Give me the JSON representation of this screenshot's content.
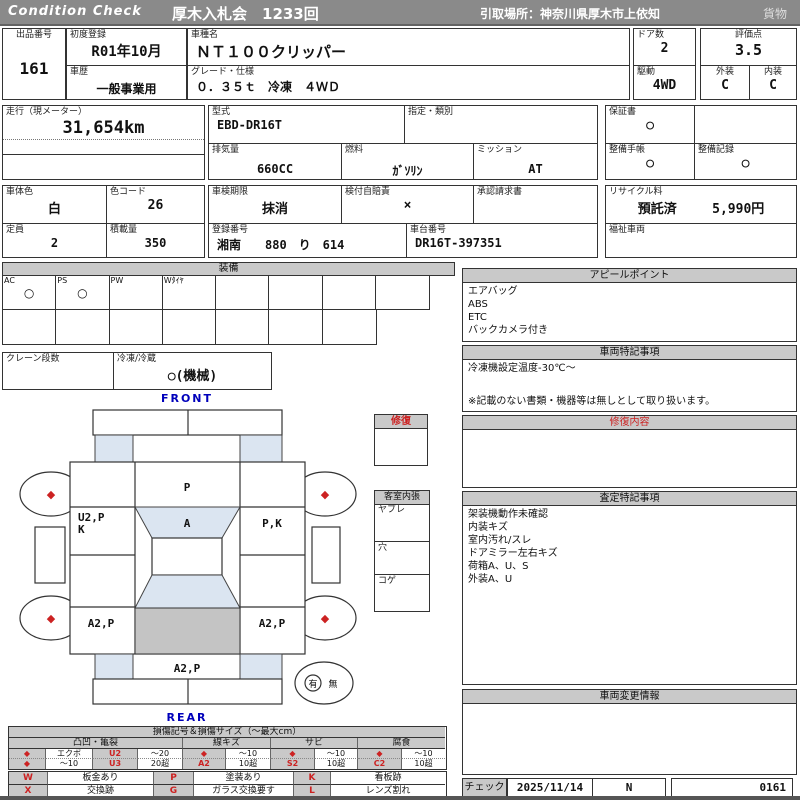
{
  "banner": {
    "brand": "Condition  Check",
    "title": "厚木入札会　1233回",
    "pickup": "引取場所：神奈川県厚木市上依知",
    "category": "貨物"
  },
  "top": {
    "lot_label": "出品番号",
    "lot": "161",
    "first_reg_label": "初度登録",
    "first_reg": "R01年10月",
    "history_label": "車歴",
    "history": "一般事業用",
    "model_label": "車種名",
    "model": "ＮＴ１００クリッパー",
    "grade_label": "グレード・仕様",
    "grade": "０．３５ｔ　冷凍　４ＷＤ",
    "doors_label": "ドア数",
    "doors": "2",
    "drive_label": "駆動",
    "drive": "4WD",
    "score_label": "評価点",
    "score": "3.5",
    "exterior_label": "外装",
    "exterior": "C",
    "interior_label": "内装",
    "interior": "C"
  },
  "specs": {
    "odometer_label": "走行（現メーター）",
    "odometer": "31,654km",
    "model_code_label": "型式",
    "model_code": "EBD-DR16T",
    "type_class_label": "指定・類別",
    "type_class": "",
    "displacement_label": "排気量",
    "displacement": "660CC",
    "fuel_label": "燃料",
    "fuel": "ｶﾞｿﾘﾝ",
    "transmission_label": "ミッション",
    "transmission": "AT",
    "warranty_label": "保証書",
    "warranty": "○",
    "maintenance_book_label": "整備手帳",
    "maintenance_book": "○",
    "maintenance_record_label": "整備記録",
    "maintenance_record": "○",
    "body_color_label": "車体色",
    "body_color": "白",
    "color_code_label": "色コード",
    "color_code": "26",
    "inspection_label": "車検期限",
    "inspection": "抹消",
    "insurance_label": "検付自賠責",
    "insurance": "×",
    "approval_label": "承認請求書",
    "approval": "",
    "capacity_label": "定員",
    "capacity": "2",
    "load_label": "積載量",
    "load": "350",
    "plate_label": "登録番号",
    "plate": "湘南　　880　り　614",
    "chassis_label": "車台番号",
    "chassis": "DR16T-397351",
    "recycle_label": "リサイクル料",
    "recycle_status": "預託済",
    "recycle_fee": "5,990円",
    "welfare_label": "福祉車両",
    "welfare": ""
  },
  "equipment": {
    "title": "装備",
    "row1": [
      {
        "label": "AC",
        "value": "○"
      },
      {
        "label": "PS",
        "value": "○"
      },
      {
        "label": "PW",
        "value": ""
      },
      {
        "label": "Wﾀｲﾔ",
        "value": ""
      },
      {
        "label": "",
        "value": ""
      },
      {
        "label": "",
        "value": ""
      },
      {
        "label": "",
        "value": ""
      },
      {
        "label": "",
        "value": ""
      }
    ],
    "crane_label": "クレーン段数",
    "crane": "",
    "reefer_label": "冷凍/冷蔵",
    "reefer": "○(機械)"
  },
  "diagram": {
    "front": "FRONT",
    "rear": "REAR",
    "wheel_mark": "◆",
    "marks": {
      "hood": "P",
      "windshield": "A",
      "left_front": "U2,P",
      "left_front2": "K",
      "right_front": "P,K",
      "left_rear": "A2,P",
      "right_rear": "A2,P",
      "rear_gate": "A2,P"
    },
    "repair_title": "修復",
    "interior_title": "客室内張",
    "interior_rows": [
      "ヤブレ",
      "穴",
      "コゲ"
    ],
    "spare_yes": "有",
    "spare_no": "無"
  },
  "right": {
    "appeal": {
      "title": "アピールポイント",
      "lines": [
        "エアバッグ",
        "ABS",
        "ETC",
        "バックカメラ付き"
      ]
    },
    "notes": {
      "title": "車両特記事項",
      "lines": [
        "冷凍機設定温度-30℃～"
      ],
      "footer": "※記載のない書類・機器等は無しとして取り扱います。"
    },
    "repair": {
      "title": "修復内容",
      "lines": []
    },
    "assessment": {
      "title": "査定特記事項",
      "lines": [
        "架装機動作未確認",
        "内装キズ",
        "室内汚れ/スレ",
        "ドアミラー左右キズ",
        "荷箱A、U、S",
        "外装A、U"
      ]
    },
    "changes": {
      "title": "車両変更情報",
      "lines": []
    },
    "check": {
      "label": "チェック",
      "date": "2025/11/14",
      "inspector": "N",
      "number": "0161"
    }
  },
  "legend": {
    "title": "損傷記号＆損傷サイズ（～最大cm）",
    "groups": [
      "凸凹・亀裂",
      "線キズ",
      "サビ",
      "腐食"
    ],
    "row1": [
      "◆",
      "エクボ",
      "U2",
      "～20",
      "◆",
      "～10",
      "◆",
      "～10",
      "◆",
      "～10"
    ],
    "row2": [
      "◆",
      "～10",
      "U3",
      "20超",
      "A2",
      "10超",
      "S2",
      "10超",
      "C2",
      "10超"
    ],
    "codes_row1": [
      "W",
      "板金あり",
      "P",
      "塗装あり",
      "K",
      "看板跡"
    ],
    "codes_row2": [
      "X",
      "交換跡",
      "G",
      "ガラス交換要す",
      "L",
      "レンズ割れ"
    ]
  },
  "colors": {
    "banner_gray": "#8a8a8a",
    "section_header_gray": "#c9c9c9",
    "accent_red": "#cc2222",
    "accent_blue": "#0000bb",
    "glass_blue": "#dbe5f1",
    "cargo_gray": "#c4c4c4"
  }
}
